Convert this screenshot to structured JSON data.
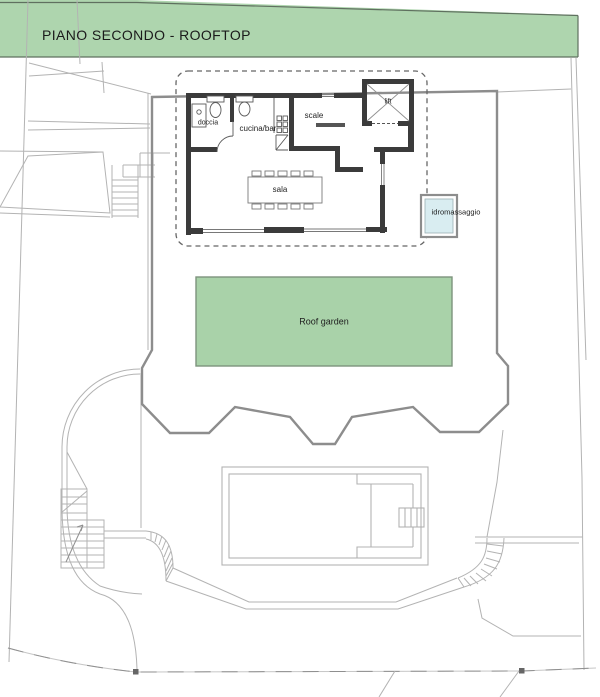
{
  "header": {
    "title": "PIANO SECONDO - ROOFTOP"
  },
  "rooms": {
    "doccia": "doccia",
    "cucina_bar": "cucina/bar",
    "scale": "scale",
    "lift": "lift",
    "sala": "sala",
    "idromassaggio": "idromassaggio"
  },
  "areas": {
    "roof_garden": "Roof garden"
  },
  "colors": {
    "band_green": "#aed5ae",
    "garden_green": "#a9d2a9",
    "tub_blue": "#d9edf1",
    "wall_dark": "#3b3b3b",
    "terrace_gray": "#8d8d8d",
    "thin_gray": "#b3b3b3"
  }
}
